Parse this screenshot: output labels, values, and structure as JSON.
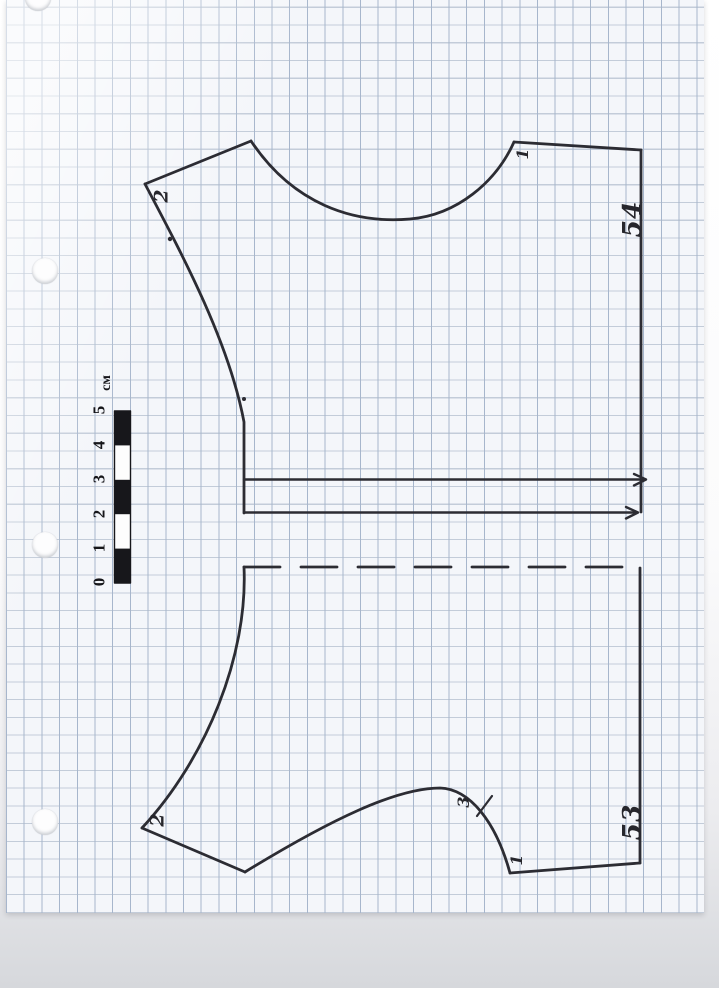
{
  "colors": {
    "paper": "#f4f6fa",
    "grid-v": "#a7b6cc",
    "grid-h": "#c3ccd9",
    "ink": "#2c2c33",
    "ruler": "#17171b",
    "scan-bottom": "#d6d8dc"
  },
  "scale_bar": {
    "unit": "см",
    "ticks": [
      "0",
      "1",
      "2",
      "3",
      "4",
      "5"
    ]
  },
  "pieces": {
    "top": {
      "number": "54",
      "mark_shoulder": "2",
      "mark_neck": "1"
    },
    "bottom": {
      "number": "53",
      "mark_shoulder": "2",
      "mark_armhole": "3",
      "mark_corner": "1"
    }
  }
}
